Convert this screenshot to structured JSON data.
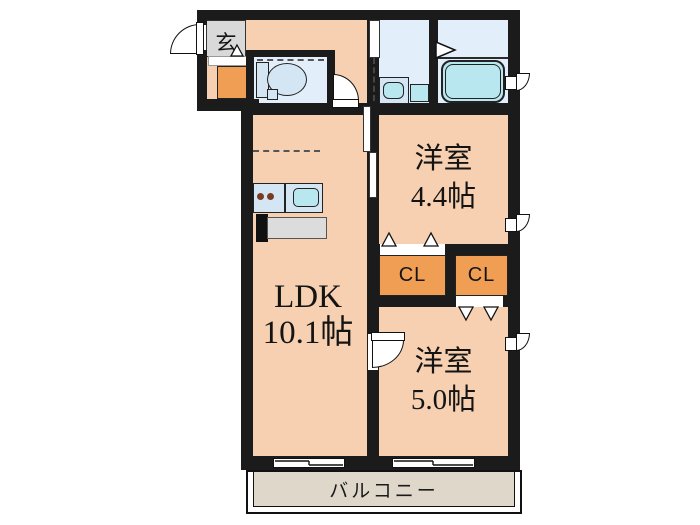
{
  "rooms": {
    "entrance": {
      "label": "玄"
    },
    "ldk": {
      "name": "LDK",
      "area": "10.1帖"
    },
    "bedroom_a": {
      "name": "洋室",
      "area": "4.4帖"
    },
    "bedroom_b": {
      "name": "洋室",
      "area": "5.0帖"
    },
    "closet_a": {
      "label": "CL"
    },
    "closet_b": {
      "label": "CL"
    },
    "balcony": {
      "label": "バルコニー"
    }
  },
  "colors": {
    "wall": "#1b1b1b",
    "room_floor": "#f6d0b0",
    "closet": "#ef9e53",
    "entrance": "#d9d9d9",
    "wet_area": "#e2effa",
    "fixture_light": "#d4e6f4",
    "fixture_cyan": "#b9e7f0",
    "balcony": "#ded7ca",
    "background": "#ffffff"
  }
}
